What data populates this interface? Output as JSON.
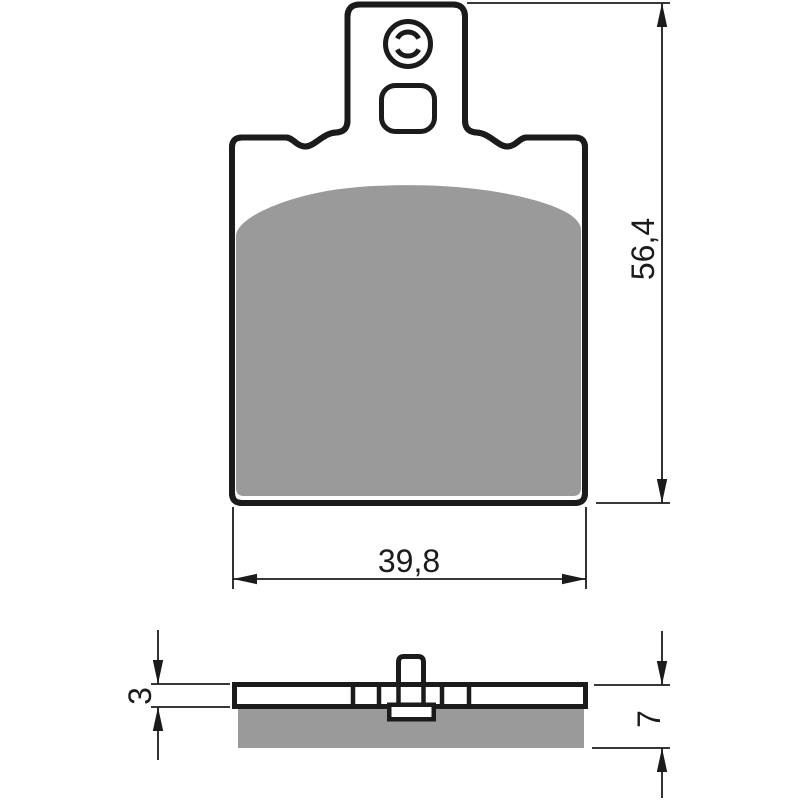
{
  "drawing": {
    "type": "technical dimension drawing",
    "subject": "brake pad",
    "views": {
      "front": {
        "name": "front view",
        "height_dim": {
          "label": "56,4"
        },
        "width_dim": {
          "label": "39,8"
        }
      },
      "side": {
        "name": "side cross-section view",
        "plate_thickness_dim": {
          "label": "3"
        },
        "total_thickness_dim": {
          "label": "7"
        }
      }
    },
    "colors": {
      "outline": "#1b1b1b",
      "friction_material": "#9a9a9a",
      "background": "#ffffff"
    }
  }
}
